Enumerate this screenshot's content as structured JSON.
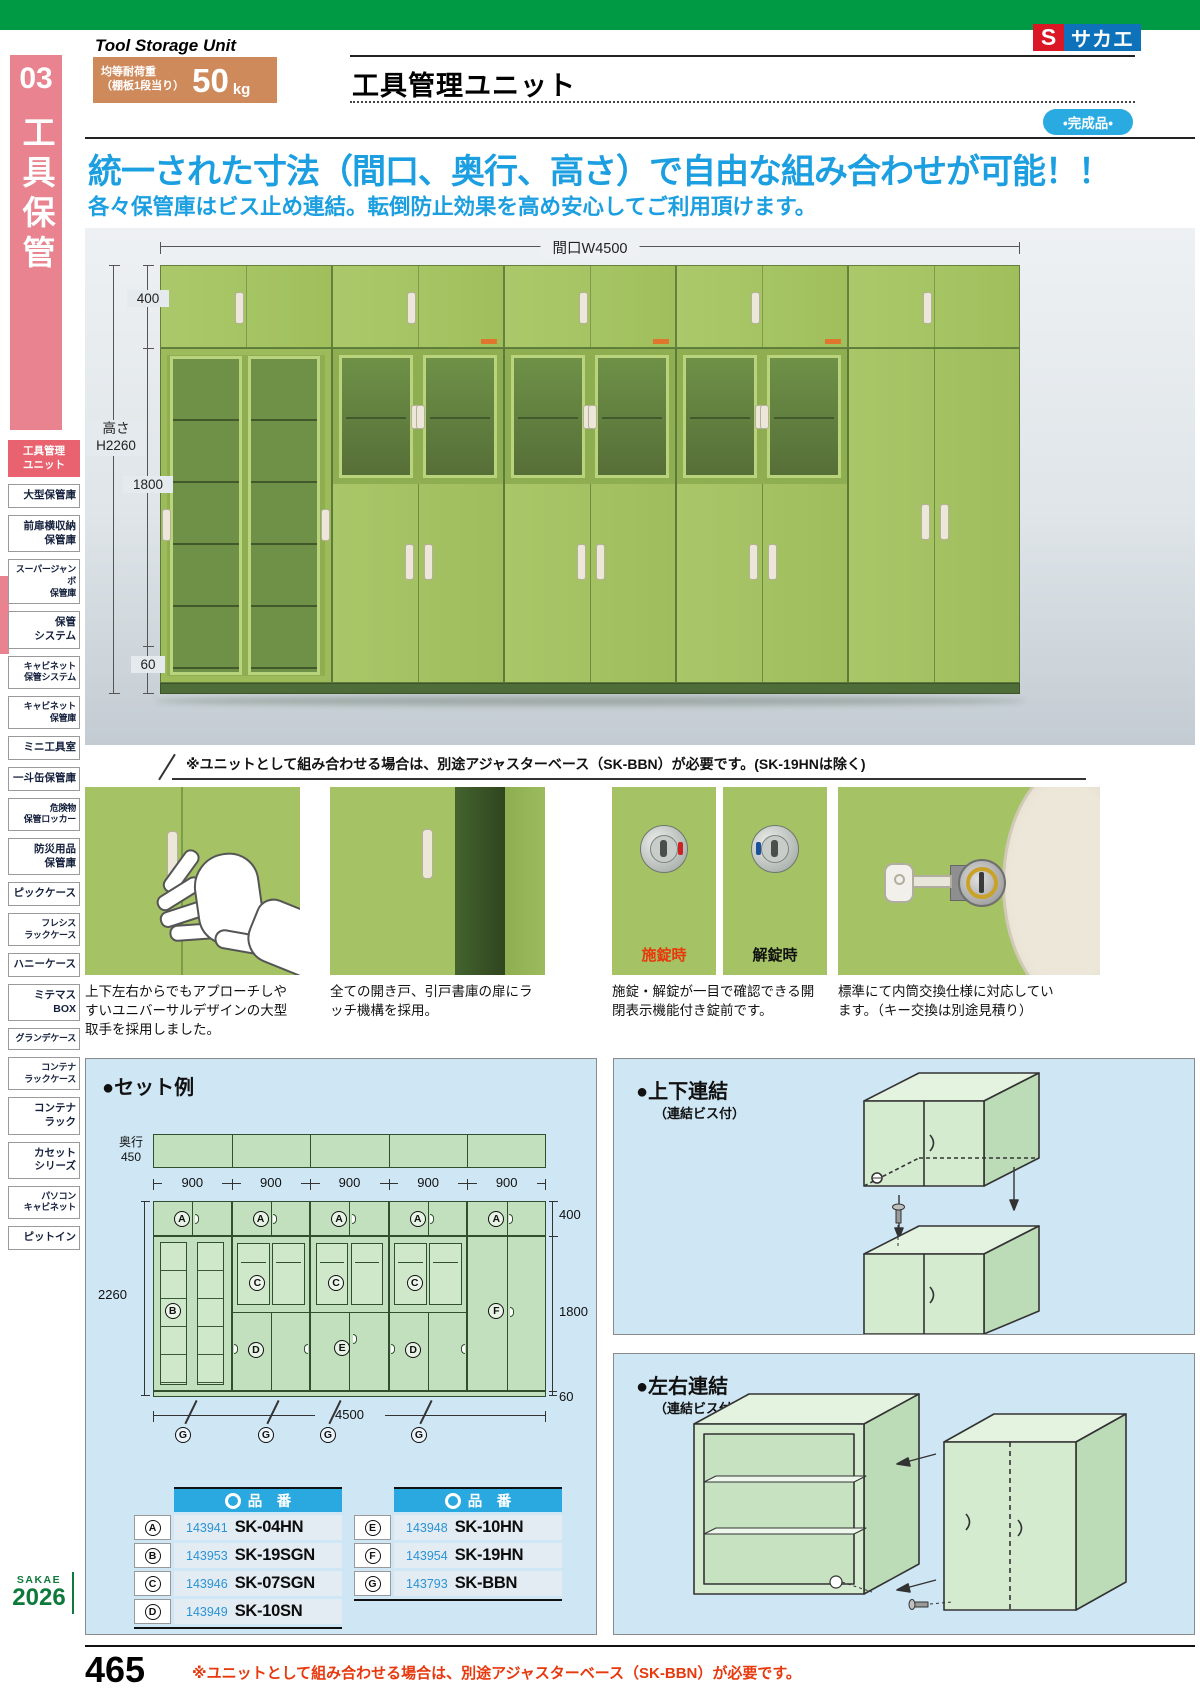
{
  "colors": {
    "brand_green": "#009a44",
    "accent_pink": "#e8838f",
    "active_pink": "#e8626f",
    "headline_blue": "#1b9fe0",
    "badge_blue": "#29abe2",
    "table_header_blue": "#29a9e0",
    "alert_red": "#e8380d",
    "load_box_orange": "#cf8a5c",
    "cabinet_green": "#a5c364",
    "panel_blue": "#cfe6f4"
  },
  "header": {
    "eyebrow": "Tool Storage Unit",
    "category_no": "03",
    "category_name": "工具保管",
    "load_line1": "均等耐荷重",
    "load_line2": "（棚板1段当り）",
    "load_value": "50",
    "load_unit": "kg",
    "title": "工具管理ユニット",
    "badge": "•完成品•",
    "logo_s": "S",
    "logo_name": "サカエ"
  },
  "headline": {
    "line1": "統一された寸法（間口、奥行、高さ）で自由な組み合わせが可能！！",
    "line2": "各々保管庫はビス止め連結。転倒防止効果を高め安心してご利用頂けます。"
  },
  "sidebar": {
    "items": [
      {
        "label": "工具管理\nユニット",
        "active": true
      },
      {
        "label": "大型保管庫"
      },
      {
        "label": "前扉横収納\n保管庫"
      },
      {
        "label": "スーパージャンボ\n保管庫"
      },
      {
        "label": "保管\nシステム"
      },
      {
        "label": "キャビネット\n保管システム"
      },
      {
        "label": "キャビネット\n保管庫"
      },
      {
        "label": "ミニ工具室"
      },
      {
        "label": "一斗缶保管庫"
      },
      {
        "label": "危険物\n保管ロッカー"
      },
      {
        "label": "防災用品\n保管庫"
      },
      {
        "label": "ピックケース"
      },
      {
        "label": "フレシス\nラックケース"
      },
      {
        "label": "ハニーケース"
      },
      {
        "label": "ミテマス\nBOX"
      },
      {
        "label": "グランデケース"
      },
      {
        "label": "コンテナ\nラックケース"
      },
      {
        "label": "コンテナ\nラック"
      },
      {
        "label": "カセット\nシリーズ"
      },
      {
        "label": "パソコン\nキャビネット"
      },
      {
        "label": "ピットイン"
      }
    ]
  },
  "main_image": {
    "dim_width": "間口W4500",
    "dim_top": "400",
    "height_label": "高さ",
    "height_value": "H2260",
    "dim_mid": "1800",
    "dim_base": "60",
    "note": "※ユニットとして組み合わせる場合は、別途アジャスターベース（SK-BBN）が必要です。(SK-19HNは除く)"
  },
  "features": [
    {
      "caption": "上下左右からでもアプローチしやすいユニバーサルデザインの大型取手を採用しました。"
    },
    {
      "caption": "全ての開き戸、引戸書庫の扉にラッチ機構を採用。"
    },
    {
      "caption": "施錠・解錠が一目で確認できる開閉表示機能付き錠前です。",
      "label_locked": "施錠時",
      "label_unlocked": "解錠時"
    },
    {
      "caption": "標準にて内筒交換仕様に対応しています。（キー交換は別途見積り）"
    }
  ],
  "set_example": {
    "title": "●セット例",
    "depth_label": "奥行",
    "depth_value": "450",
    "segments": [
      "900",
      "900",
      "900",
      "900",
      "900"
    ],
    "total_width": "4500",
    "height_total": "2260",
    "dim_top": "400",
    "dim_mid": "1800",
    "dim_base": "60",
    "markers": {
      "a": "A",
      "b": "B",
      "c": "C",
      "d": "D",
      "e": "E",
      "f": "F",
      "g": "G"
    },
    "tables": [
      {
        "header": "品　番",
        "rows": [
          {
            "letter": "A",
            "num": "143941",
            "code": "SK-04HN"
          },
          {
            "letter": "B",
            "num": "143953",
            "code": "SK-19SGN"
          },
          {
            "letter": "C",
            "num": "143946",
            "code": "SK-07SGN"
          },
          {
            "letter": "D",
            "num": "143949",
            "code": "SK-10SN"
          }
        ]
      },
      {
        "header": "品　番",
        "rows": [
          {
            "letter": "E",
            "num": "143948",
            "code": "SK-10HN"
          },
          {
            "letter": "F",
            "num": "143954",
            "code": "SK-19HN"
          },
          {
            "letter": "G",
            "num": "143793",
            "code": "SK-BBN"
          }
        ]
      }
    ]
  },
  "link_panels": {
    "vertical": {
      "title": "●上下連結",
      "subtitle": "（連結ビス付）"
    },
    "horizontal": {
      "title": "●左右連結",
      "subtitle": "（連結ビス付）"
    }
  },
  "footer": {
    "page_number": "465",
    "note": "※ユニットとして組み合わせる場合は、別途アジャスターベース（SK-BBN）が必要です。",
    "catalog_brand": "SAKAE",
    "catalog_year": "2026"
  }
}
